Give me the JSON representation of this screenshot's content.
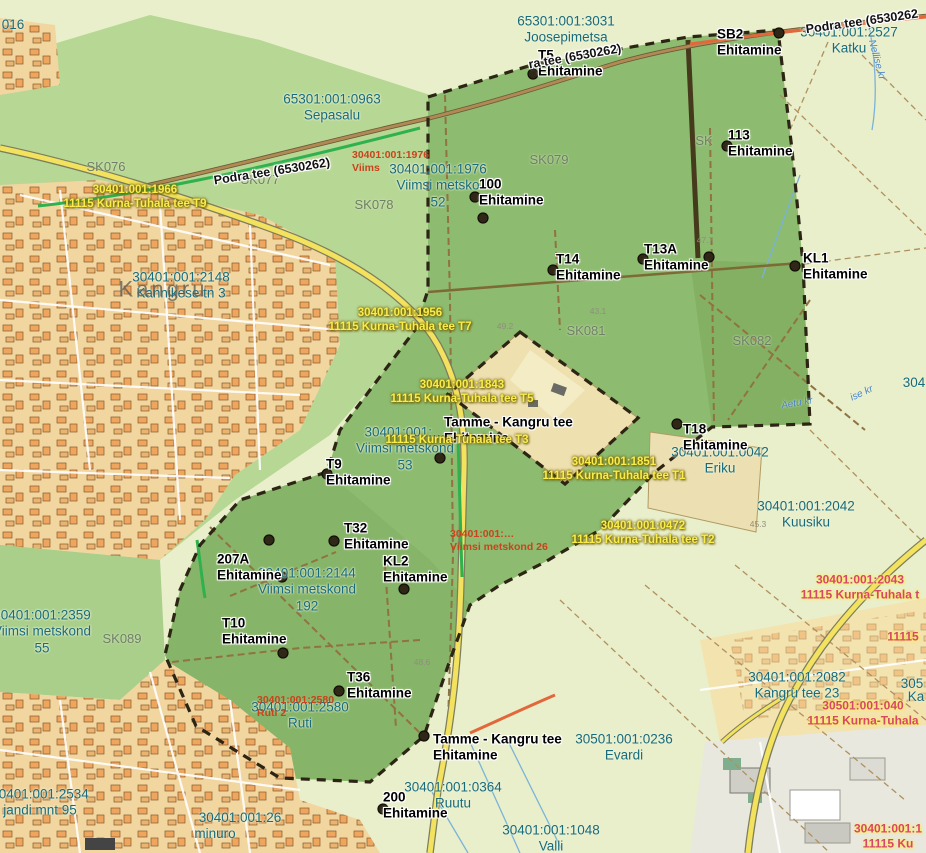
{
  "colors": {
    "field": "#e9efcb",
    "forest": "#b7d794",
    "urban": "#f2d6a0",
    "selection_green": "#8dbb70",
    "boundary": "#2c2514",
    "teal": "#1a6b7a",
    "yellow": "#f8ed4d",
    "red": "#c8441c",
    "pink": "#d5486a",
    "road_yellow": "#f2e25e",
    "road_orange": "#e2683b",
    "highlight_green": "#2fb14e"
  },
  "labels": [
    {
      "text": "016",
      "x": 13,
      "y": 25,
      "type": "cad"
    },
    {
      "text": "65301:001:3031\nJoosepimetsa",
      "x": 566,
      "y": 30,
      "type": "cad"
    },
    {
      "text": "30401:001:2527\nKatku",
      "x": 849,
      "y": 41,
      "type": "cad"
    },
    {
      "text": "65301:001:0963\nSepasalu",
      "x": 332,
      "y": 108,
      "type": "cad"
    },
    {
      "text": "30401:001:1976\nViimsi metsko\n52",
      "x": 438,
      "y": 186,
      "type": "cad"
    },
    {
      "text": "30401:001:2148\nKannikese tn 3",
      "x": 181,
      "y": 286,
      "type": "cad"
    },
    {
      "text": "30401:001:…\nViimsi metskond\n53",
      "x": 405,
      "y": 449,
      "type": "cad"
    },
    {
      "text": "30401:001:0042\nEriku",
      "x": 720,
      "y": 461,
      "type": "cad"
    },
    {
      "text": "30401:001:2144\nViimsi metskond\n192",
      "x": 307,
      "y": 590,
      "type": "cad"
    },
    {
      "text": "30401:001:2359\nViimsi metskond\n55",
      "x": 42,
      "y": 632,
      "type": "cad"
    },
    {
      "text": "30401:001:2580\nRuti",
      "x": 300,
      "y": 716,
      "type": "cad"
    },
    {
      "text": "30401:001:0364\nRuutu",
      "x": 453,
      "y": 796,
      "type": "cad"
    },
    {
      "text": "30401:001:1048\nValli",
      "x": 551,
      "y": 839,
      "type": "cad"
    },
    {
      "text": "30501:001:0236\nEvardi",
      "x": 624,
      "y": 748,
      "type": "cad"
    },
    {
      "text": "30401:001:2082\nKangru tee 23",
      "x": 797,
      "y": 686,
      "type": "cad"
    },
    {
      "text": "30401:001:2042\nKuusiku",
      "x": 806,
      "y": 515,
      "type": "cad"
    },
    {
      "text": "30401:001:2534\njandi mnt 95",
      "x": 40,
      "y": 803,
      "type": "cad"
    },
    {
      "text": "30401:001:26",
      "x": 240,
      "y": 818,
      "type": "cad"
    },
    {
      "text": "minuro",
      "x": 215,
      "y": 834,
      "type": "cad"
    },
    {
      "text": "304",
      "x": 914,
      "y": 383,
      "type": "cad"
    },
    {
      "text": "305",
      "x": 912,
      "y": 684,
      "type": "cad"
    },
    {
      "text": "Ka",
      "x": 916,
      "y": 697,
      "type": "cad"
    },
    {
      "text": "SK076",
      "x": 106,
      "y": 167,
      "type": "sk"
    },
    {
      "text": "SK077",
      "x": 260,
      "y": 180,
      "type": "sk"
    },
    {
      "text": "SK078",
      "x": 374,
      "y": 205,
      "type": "sk"
    },
    {
      "text": "SK079",
      "x": 549,
      "y": 160,
      "type": "sk"
    },
    {
      "text": "SK081",
      "x": 586,
      "y": 331,
      "type": "sk"
    },
    {
      "text": "SK082",
      "x": 752,
      "y": 341,
      "type": "sk"
    },
    {
      "text": "SK089",
      "x": 122,
      "y": 639,
      "type": "sk"
    },
    {
      "text": "SK",
      "x": 704,
      "y": 141,
      "type": "sk"
    },
    {
      "text": "SB2\nEhitamine",
      "x": 717,
      "y": 43,
      "type": "marker"
    },
    {
      "text": "T5\nEhitamine",
      "x": 538,
      "y": 64,
      "type": "marker"
    },
    {
      "text": "113\nEhitamine",
      "x": 728,
      "y": 144,
      "type": "marker"
    },
    {
      "text": "100\nEhitamine",
      "x": 479,
      "y": 193,
      "type": "marker"
    },
    {
      "text": "T14\nEhitamine",
      "x": 556,
      "y": 268,
      "type": "marker"
    },
    {
      "text": "T13A\nEhitamine",
      "x": 644,
      "y": 258,
      "type": "marker"
    },
    {
      "text": "KL1\nEhitamine",
      "x": 803,
      "y": 267,
      "type": "marker"
    },
    {
      "text": "T18\nEhitamine",
      "x": 683,
      "y": 438,
      "type": "marker"
    },
    {
      "text": "Tamme - Kangru tee\nEhitamine",
      "x": 444,
      "y": 431,
      "type": "marker"
    },
    {
      "text": "T9\nEhitamine",
      "x": 326,
      "y": 473,
      "type": "marker"
    },
    {
      "text": "T32\nEhitamine",
      "x": 344,
      "y": 537,
      "type": "marker"
    },
    {
      "text": "KL2\nEhitamine",
      "x": 383,
      "y": 570,
      "type": "marker"
    },
    {
      "text": "207A\nEhitamine",
      "x": 217,
      "y": 568,
      "type": "marker"
    },
    {
      "text": "T10\nEhitamine",
      "x": 222,
      "y": 632,
      "type": "marker"
    },
    {
      "text": "T36\nEhitamine",
      "x": 347,
      "y": 686,
      "type": "marker"
    },
    {
      "text": "Tamme - Kangru tee\nEhitamine",
      "x": 433,
      "y": 748,
      "type": "marker"
    },
    {
      "text": "200\nEhitamine",
      "x": 383,
      "y": 806,
      "type": "marker"
    },
    {
      "text": "30401:001:1966\n11115 Kurna-Tuhala tee T9",
      "x": 135,
      "y": 197,
      "type": "yellow"
    },
    {
      "text": "30401:001:1956\n11115 Kurna-Tuhala tee T7",
      "x": 400,
      "y": 320,
      "type": "yellow"
    },
    {
      "text": "30401:001:1843\n11115 Kurna-Tuhala tee T5",
      "x": 462,
      "y": 392,
      "type": "yellow"
    },
    {
      "text": "11115 Kurna-Tuhala tee T3",
      "x": 457,
      "y": 440,
      "type": "yellow"
    },
    {
      "text": "30401:001:1851\n11115 Kurna-Tuhala tee T1",
      "x": 614,
      "y": 469,
      "type": "yellow"
    },
    {
      "text": "30401:001:0472\n11115 Kurna-Tuhala tee T2",
      "x": 643,
      "y": 533,
      "type": "yellow"
    },
    {
      "text": "30401:001:1976\nViims",
      "x": 352,
      "y": 162,
      "type": "red"
    },
    {
      "text": "30401:001:…\nViimsi metskond 26",
      "x": 450,
      "y": 541,
      "type": "red"
    },
    {
      "text": "30401:001:2580\nRuti 2",
      "x": 257,
      "y": 707,
      "type": "red"
    },
    {
      "text": "30401:001:2043\n11115 Kurna-Tuhala t",
      "x": 860,
      "y": 587,
      "type": "pink"
    },
    {
      "text": "30501:001:040\n11115 Kurna-Tuhala",
      "x": 863,
      "y": 713,
      "type": "pink"
    },
    {
      "text": "11115",
      "x": 903,
      "y": 637,
      "type": "pink"
    },
    {
      "text": "30401:001:1\n11115 Ku",
      "x": 888,
      "y": 836,
      "type": "pink"
    },
    {
      "text": "Podra tee (6530262)",
      "x": 272,
      "y": 172,
      "type": "roadname",
      "rot": -9
    },
    {
      "text": "Podra tee (6530262",
      "x": 862,
      "y": 22,
      "type": "roadname",
      "rot": -8
    },
    {
      "text": "ra tee (6530262)",
      "x": 575,
      "y": 57,
      "type": "roadname",
      "rot": -10
    },
    {
      "text": "Kangru",
      "x": 163,
      "y": 290,
      "type": "place"
    },
    {
      "text": "Nellise kr",
      "x": 876,
      "y": 60,
      "type": "blue",
      "rot": 75
    },
    {
      "text": "ise kr",
      "x": 862,
      "y": 394,
      "type": "blue",
      "rot": -25
    },
    {
      "text": "Äetu kr",
      "x": 797,
      "y": 404,
      "type": "blue",
      "rot": -10
    },
    {
      "text": "47.7",
      "x": 705,
      "y": 240,
      "type": "elev"
    },
    {
      "text": "49.2",
      "x": 505,
      "y": 326,
      "type": "elev"
    },
    {
      "text": "43.1",
      "x": 598,
      "y": 311,
      "type": "elev"
    },
    {
      "text": "45.3",
      "x": 758,
      "y": 524,
      "type": "elev"
    },
    {
      "text": "48.6",
      "x": 422,
      "y": 662,
      "type": "elev"
    }
  ],
  "markers": [
    {
      "x": 779,
      "y": 33
    },
    {
      "x": 533,
      "y": 74
    },
    {
      "x": 727,
      "y": 146
    },
    {
      "x": 475,
      "y": 197
    },
    {
      "x": 483,
      "y": 218
    },
    {
      "x": 553,
      "y": 270
    },
    {
      "x": 643,
      "y": 259
    },
    {
      "x": 709,
      "y": 257
    },
    {
      "x": 795,
      "y": 266
    },
    {
      "x": 677,
      "y": 424
    },
    {
      "x": 440,
      "y": 458
    },
    {
      "x": 327,
      "y": 474
    },
    {
      "x": 269,
      "y": 540
    },
    {
      "x": 334,
      "y": 541
    },
    {
      "x": 282,
      "y": 577
    },
    {
      "x": 404,
      "y": 589
    },
    {
      "x": 283,
      "y": 653
    },
    {
      "x": 339,
      "y": 691
    },
    {
      "x": 424,
      "y": 736
    },
    {
      "x": 383,
      "y": 809
    }
  ]
}
